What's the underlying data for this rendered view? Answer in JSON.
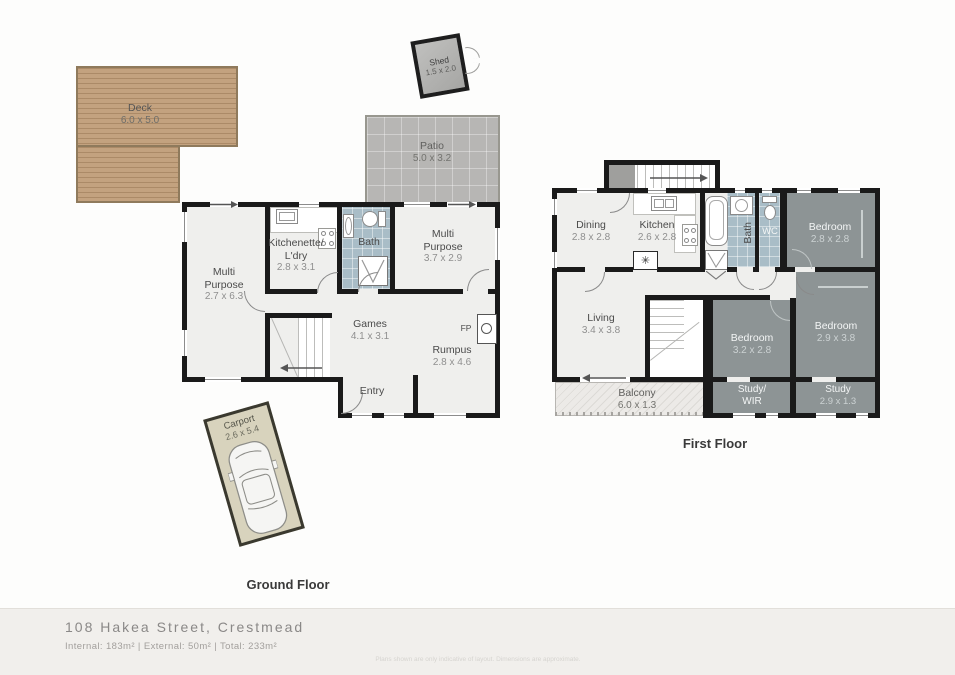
{
  "footer": {
    "address": "108 Hakea Street, Crestmead",
    "areas": "Internal: 183m² | External:   50m² | Total: 233m²",
    "disclaimer": "Plans shown are only indicative of layout. Dimensions are approximate."
  },
  "captions": {
    "ground": "Ground Floor",
    "first": "First Floor"
  },
  "ground": {
    "deck": {
      "name": "Deck",
      "dims": "6.0 x 5.0"
    },
    "shed": {
      "name": "Shed",
      "dims": "1.5 x 2.0"
    },
    "patio": {
      "name": "Patio",
      "dims": "5.0 x 3.2"
    },
    "carport": {
      "name": "Carport",
      "dims": "2.6 x 5.4"
    },
    "multi_left": {
      "name": "Multi\nPurpose",
      "dims": "2.7 x 6.3"
    },
    "kitchenette": {
      "name": "Kitchenette/\nL'dry",
      "dims": "2.8 x 3.1"
    },
    "bath": {
      "name": "Bath"
    },
    "multi_right": {
      "name": "Multi\nPurpose",
      "dims": "3.7 x 2.9"
    },
    "games": {
      "name": "Games",
      "dims": "4.1 x 3.1"
    },
    "rumpus": {
      "name": "Rumpus",
      "dims": "2.8 x 4.6"
    },
    "entry": {
      "name": "Entry"
    },
    "fireplace": "FP"
  },
  "first": {
    "dining": {
      "name": "Dining",
      "dims": "2.8 x 2.8"
    },
    "kitchen": {
      "name": "Kitchen",
      "dims": "2.6 x 2.8"
    },
    "bath": {
      "name": "Bath"
    },
    "wc": {
      "name": "WC"
    },
    "bedroom1": {
      "name": "Bedroom",
      "dims": "2.8 x 2.8"
    },
    "living": {
      "name": "Living",
      "dims": "3.4 x 3.8"
    },
    "bedroom2": {
      "name": "Bedroom",
      "dims": "3.2 x 2.8"
    },
    "bedroom3": {
      "name": "Bedroom",
      "dims": "2.9 x 3.8"
    },
    "study_wir": {
      "name": "Study/\nWIR"
    },
    "study": {
      "name": "Study",
      "dims": "2.9 x 1.3"
    },
    "balcony": {
      "name": "Balcony",
      "dims": "6.0 x 1.3"
    }
  },
  "symbols": {
    "dishwasher": "✳"
  },
  "colors": {
    "wall": "#1a1a1a",
    "floor": "#efefed",
    "bedroom_fill": "#8d9495",
    "bath_tiles": "#a9bdc7",
    "deck_wood": "#c3a27f",
    "patio": "#b7b6b4",
    "carport": "#d8d3bd",
    "balcony": "#eceae7",
    "footer_band": "#f1efec"
  }
}
